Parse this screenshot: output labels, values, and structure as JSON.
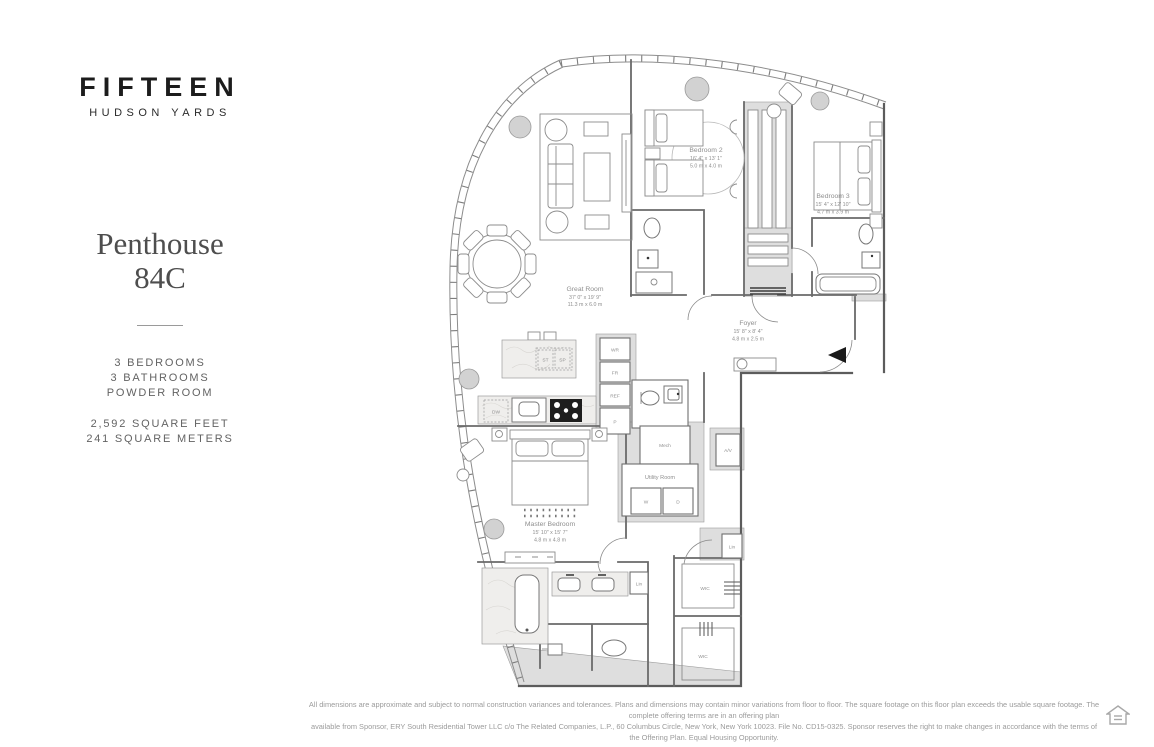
{
  "sidebar": {
    "logo_line1": "FIFTEEN",
    "logo_line2": "HUDSON YARDS",
    "unit_title_line1": "Penthouse",
    "unit_title_line2": "84C",
    "features": [
      "3 BEDROOMS",
      "3 BATHROOMS",
      "POWDER ROOM"
    ],
    "area": [
      "2,592 SQUARE FEET",
      "241 SQUARE METERS"
    ]
  },
  "plan": {
    "rooms": {
      "great_room": {
        "name": "Great Room",
        "dim_ft": "37' 0\" x 19' 9\"",
        "dim_m": "11.3 m  x  6.0 m"
      },
      "bedroom2": {
        "name": "Bedroom 2",
        "dim_ft": "16' 4\" x 13' 1\"",
        "dim_m": "5.0 m  x  4.0 m"
      },
      "bedroom3": {
        "name": "Bedroom 3",
        "dim_ft": "15' 4\" x 12' 10\"",
        "dim_m": "4.7 m  x  3.9 m"
      },
      "foyer": {
        "name": "Foyer",
        "dim_ft": "15' 8\" x 8' 4\"",
        "dim_m": "4.8 m  x  2.5 m"
      },
      "master_bedroom": {
        "name": "Master Bedroom",
        "dim_ft": "15' 10\" x 15' 7\"",
        "dim_m": "4.8 m  x  4.8 m"
      },
      "utility_room": {
        "name": "Utility Room"
      },
      "mech": {
        "name": "Mech"
      }
    },
    "labels": {
      "wr": "WR",
      "fr": "FR",
      "ref": "REF",
      "p": "P",
      "st": "ST",
      "sp": "SP",
      "dw": "DW",
      "w": "W",
      "d": "D",
      "av": "A/V",
      "lin_bath": "Lin",
      "lin_hall": "Lin",
      "wic1": "WIC",
      "wic2": "WIC"
    }
  },
  "footer": {
    "line1": "All dimensions are approximate and subject to normal construction variances and tolerances. Plans and dimensions may contain minor variations from floor to floor. The square footage on this floor plan exceeds the usable square footage. The complete offering terms are in an offering plan",
    "line2": "available from Sponsor, ERY South Residential Tower LLC c/o The Related Companies, L.P., 60 Columbus Circle, New York, New York 10023. File No. CD15-0325. Sponsor reserves the right to make changes in accordance with the terms of the Offering Plan. Equal Housing Opportunity."
  }
}
